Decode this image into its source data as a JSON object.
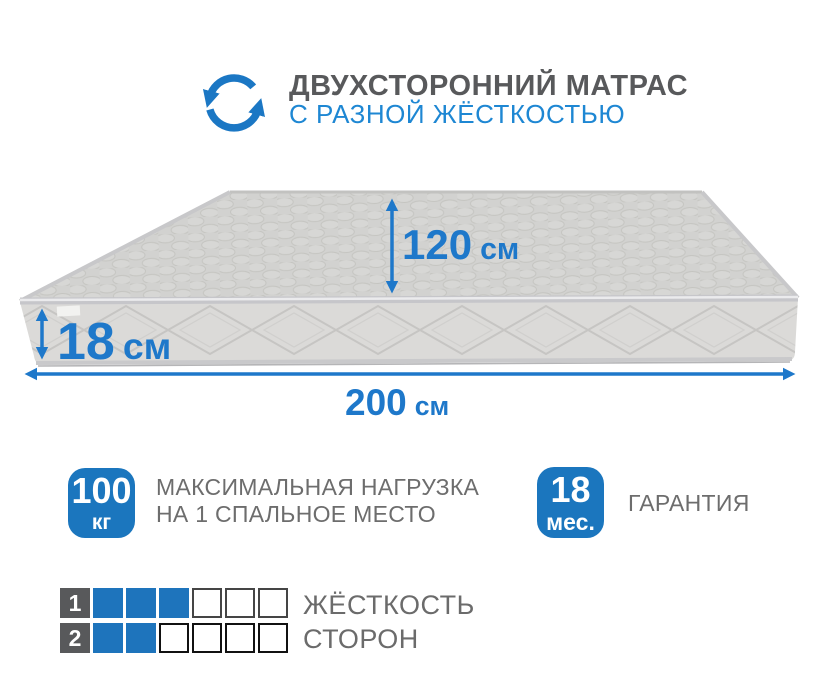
{
  "header": {
    "icon": "rotate-arrows-icon",
    "title": "ДВУХСТОРОННИЙ МАТРАС",
    "subtitle": "С РАЗНОЙ ЖЁСТКОСТЬЮ"
  },
  "diagram": {
    "depth": {
      "value": "120",
      "unit": "см"
    },
    "height": {
      "value": "18",
      "unit": "см"
    },
    "width": {
      "value": "200",
      "unit": "см"
    }
  },
  "badges": {
    "max_load": {
      "value": "100",
      "unit": "кг",
      "caption_line1": "МАКСИМАЛЬНАЯ НАГРУЗКА",
      "caption_line2": "НА 1 СПАЛЬНОЕ МЕСТО"
    },
    "warranty": {
      "value": "18",
      "unit": "мес.",
      "caption": "ГАРАНТИЯ"
    }
  },
  "firmness": {
    "caption_line1": "ЖЁСТКОСТЬ",
    "caption_line2": "СТОРОН",
    "rows": [
      {
        "number": "1",
        "filled": 3,
        "total": 6
      },
      {
        "number": "2",
        "filled": 2,
        "total": 6
      }
    ]
  },
  "colors": {
    "accent_blue": "#1b76be",
    "dimension_blue": "#1e78ca",
    "subtitle_blue": "#1e87d3",
    "title_gray": "#58595b",
    "text_gray": "#6d6d6d",
    "mattress_top": "#d2d2d0",
    "mattress_front": "#dbdad8"
  }
}
